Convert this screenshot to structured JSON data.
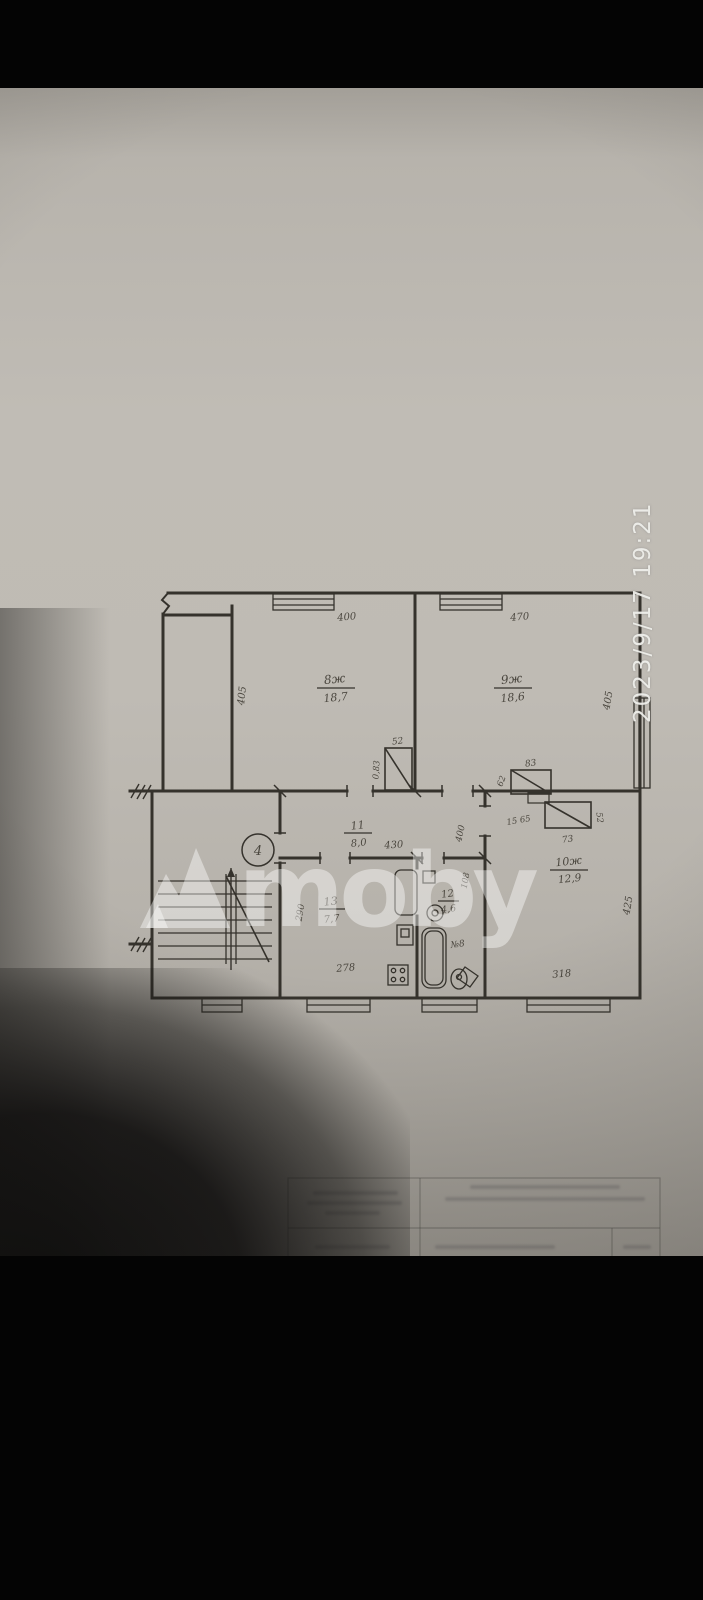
{
  "photo": {
    "timestamp": "2023/9/17  19:21"
  },
  "watermark": {
    "text": "moby"
  },
  "plan": {
    "stair_label": "4",
    "rooms": {
      "room8": {
        "number": "8ж",
        "area": "18,7",
        "dim_top": "400",
        "dim_left": "405"
      },
      "room9": {
        "number": "9ж",
        "area": "18,6",
        "dim_top": "470",
        "dim_right": "405"
      },
      "room10": {
        "number": "10ж",
        "area": "12,9",
        "dim_bottom": "318",
        "dim_right": "425"
      },
      "corridor": {
        "number": "11",
        "area": "8,0",
        "dim": "430",
        "dim_right": "400"
      },
      "kitchen": {
        "number": "13",
        "area": "7,7",
        "dim_bottom": "278",
        "dim_left": "290"
      },
      "bathroom": {
        "number": "12",
        "area": "4,6",
        "dim_right": "108",
        "toilet_label": "№8"
      },
      "closet_room8": {
        "dim_top": "52",
        "dim_left": "0,83"
      },
      "closet_room9": {
        "dim_top": "83",
        "dim_left": "62"
      },
      "closet_room10": {
        "label": "15 65",
        "dim_bottom": "73",
        "dim_right": "52"
      }
    }
  },
  "title_block": {
    "address_line1": "ул. Заводская",
    "address_line2": "№ 8,  кв. 4",
    "subject_line1": "выкопировка",
    "subject_line2": "квартиры",
    "scale": "100",
    "row1_name": "Мороз",
    "row1_right": "Марович 25.06.03",
    "row2_right": "Иватницкого 06.07.03"
  }
}
